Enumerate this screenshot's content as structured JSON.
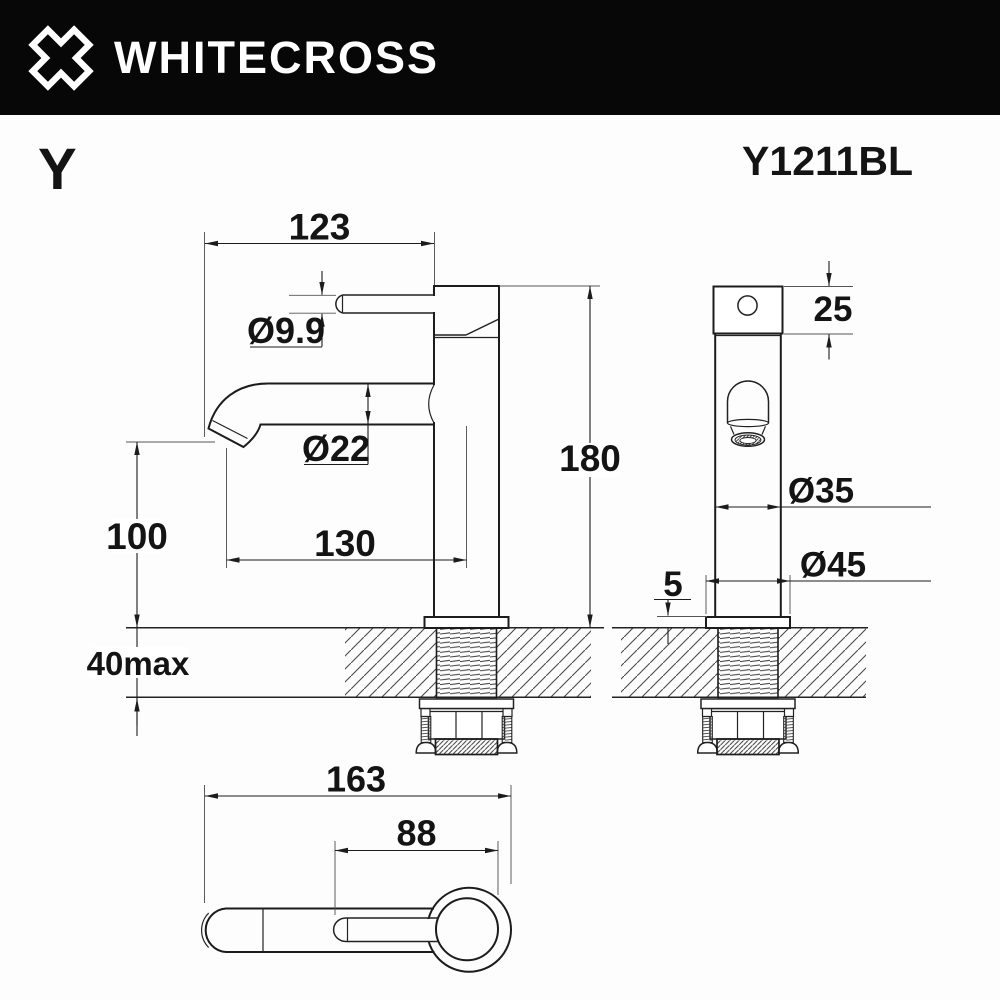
{
  "header": {
    "brand": "WHITECROSS"
  },
  "product": {
    "series": "Y",
    "model": "Y1211BL"
  },
  "views": {
    "front": {
      "dims": {
        "spout_reach": "123",
        "handle_stem_dia": "Ø9.9",
        "spout_dia": "Ø22",
        "spout_offset": "130",
        "spout_height": "100",
        "overall_height": "180",
        "deck_thickness": "40max"
      }
    },
    "side": {
      "dims": {
        "cap_height": "25",
        "body_dia": "Ø35",
        "base_dia": "Ø45",
        "base_plate_thickness": "5"
      }
    },
    "top": {
      "dims": {
        "overall_depth": "163",
        "handle_length": "88"
      }
    }
  }
}
